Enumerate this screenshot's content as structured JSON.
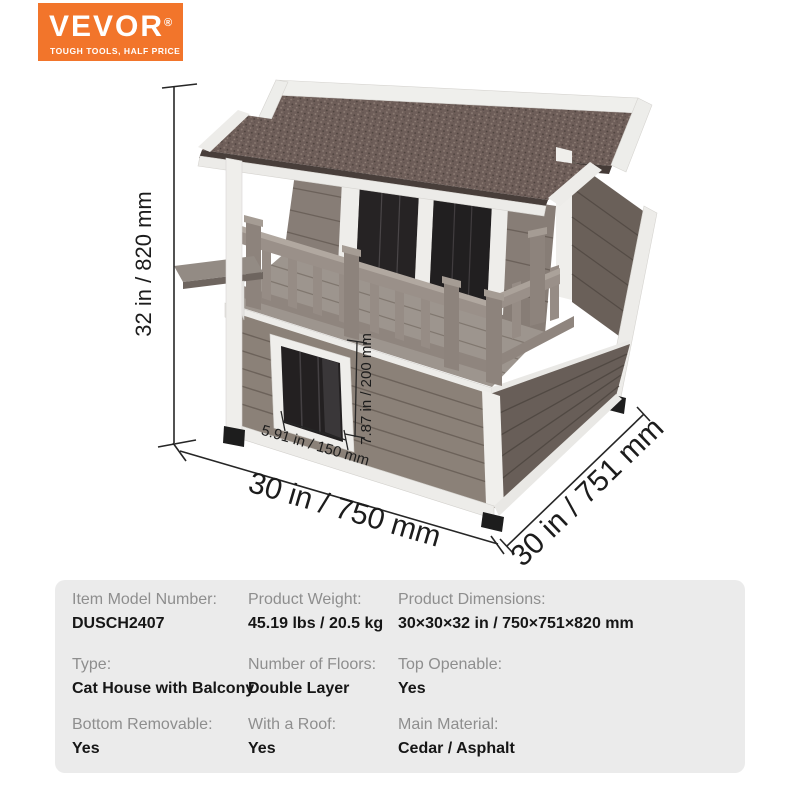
{
  "brand": {
    "name": "VEVOR",
    "registered_mark": "®",
    "tagline": "TOUGH TOOLS, HALF PRICE",
    "logo_bg": "#F2752B"
  },
  "product": {
    "name": "Cat House with Balcony"
  },
  "dimensions": {
    "overall_height": "32 in / 820 mm",
    "front_width": "30 in / 750 mm",
    "side_depth": "30 in / 751 mm",
    "door_width": "5.91 in / 150 mm",
    "door_height": "7.87 in / 200 mm"
  },
  "colors": {
    "roof_asphalt": "#6E5E59",
    "wall_wood_front": "#8B8178",
    "wall_wood_side": "#685E58",
    "trim_white": "#EFEEEB",
    "accent_orange": "#F2752B",
    "panel_gray": "#EBEBEB"
  },
  "specs": {
    "items": [
      {
        "label": "Item Model Number:",
        "value": "DUSCH2407"
      },
      {
        "label": "Product Weight:",
        "value": "45.19 lbs / 20.5 kg"
      },
      {
        "label": "Product Dimensions:",
        "value": "30×30×32 in / 750×751×820 mm"
      },
      {
        "label": "Type:",
        "value": "Cat House with Balcony"
      },
      {
        "label": "Number of Floors:",
        "value": "Double Layer"
      },
      {
        "label": "Top Openable:",
        "value": "Yes"
      },
      {
        "label": "Bottom Removable:",
        "value": "Yes"
      },
      {
        "label": "With a Roof:",
        "value": "Yes"
      },
      {
        "label": "Main Material:",
        "value": "Cedar / Asphalt"
      }
    ]
  }
}
